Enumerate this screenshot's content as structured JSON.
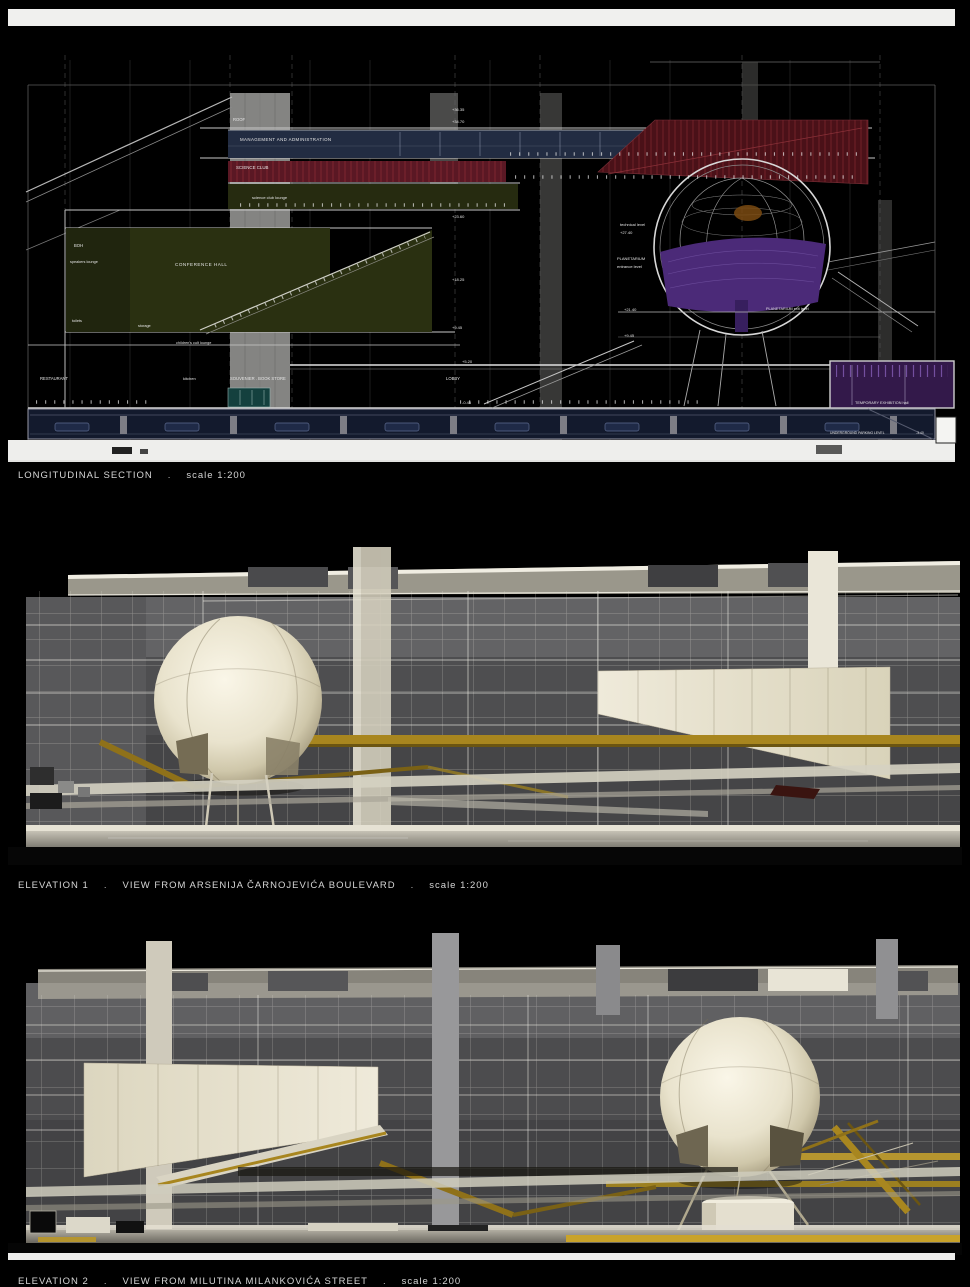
{
  "captions": {
    "section": {
      "title": "LONGITUDINAL SECTION",
      "sep": ".",
      "scale": "scale 1:200"
    },
    "elevation1": {
      "title": "ELEVATION 1",
      "sep": ".",
      "view": "VIEW FROM ARSENIJA ČARNOJEVIĆA BOULEVARD",
      "scale": "scale 1:200"
    },
    "elevation2": {
      "title": "ELEVATION 2",
      "sep": ".",
      "view": "VIEW FROM MILUTINA MILANKOVIĆA STREET",
      "scale": "scale 1:200"
    }
  },
  "section": {
    "rooms": {
      "roof": "ROOF",
      "management": "MANAGEMENT AND ADMINISTRATION",
      "science_club": "SCIENCE CLUB",
      "science_club_lounge": "science club lounge",
      "boh": "BOH",
      "speakers_lounge": "speakers lounge",
      "conference_hall": "CONFERENCE HALL",
      "storage": "storage",
      "toilets": "toilets",
      "childrens_lounge": "children's cult lounge",
      "restaurant": "RESTAURANT",
      "kitchen": "kitchen",
      "souvenir_book_store": "SOUVENIER . BOOK STORE",
      "lobby": "LOBBY",
      "technical_level": "technical level",
      "planetarium_line1": "PLANETARIUM",
      "planetarium_line2": "entrance level",
      "planetarium_exit": "PLANETARIUM  exit level",
      "temporary_exhibition": "TEMPORARY EXHIBITION  hall",
      "underground_parking": "UNDERGROUND PARKING LEVEL"
    },
    "levels": {
      "l36": "+36.35",
      "l34": "+34.70",
      "l27": "+27.40",
      "l23": "+23.60",
      "l21": "+21.40",
      "l18": "+18.25",
      "l9": "+9.45",
      "l5": "+5.20",
      "l0": "-0.45",
      "lp": "-3.40"
    }
  },
  "colors": {
    "admin_navy": "#222c42",
    "science_red": "#5a1824",
    "auditorium_red": "#4a1118",
    "olive_green": "#2a3011",
    "planetarium_purple": "#4b2a78",
    "exhibition_purple": "#33194a",
    "souvenir_teal": "#14403e",
    "parking_navy": "#131a2d",
    "render_gold": "#a8861f",
    "render_cream": "#eae5d2",
    "render_grey": "#4e4e50"
  }
}
